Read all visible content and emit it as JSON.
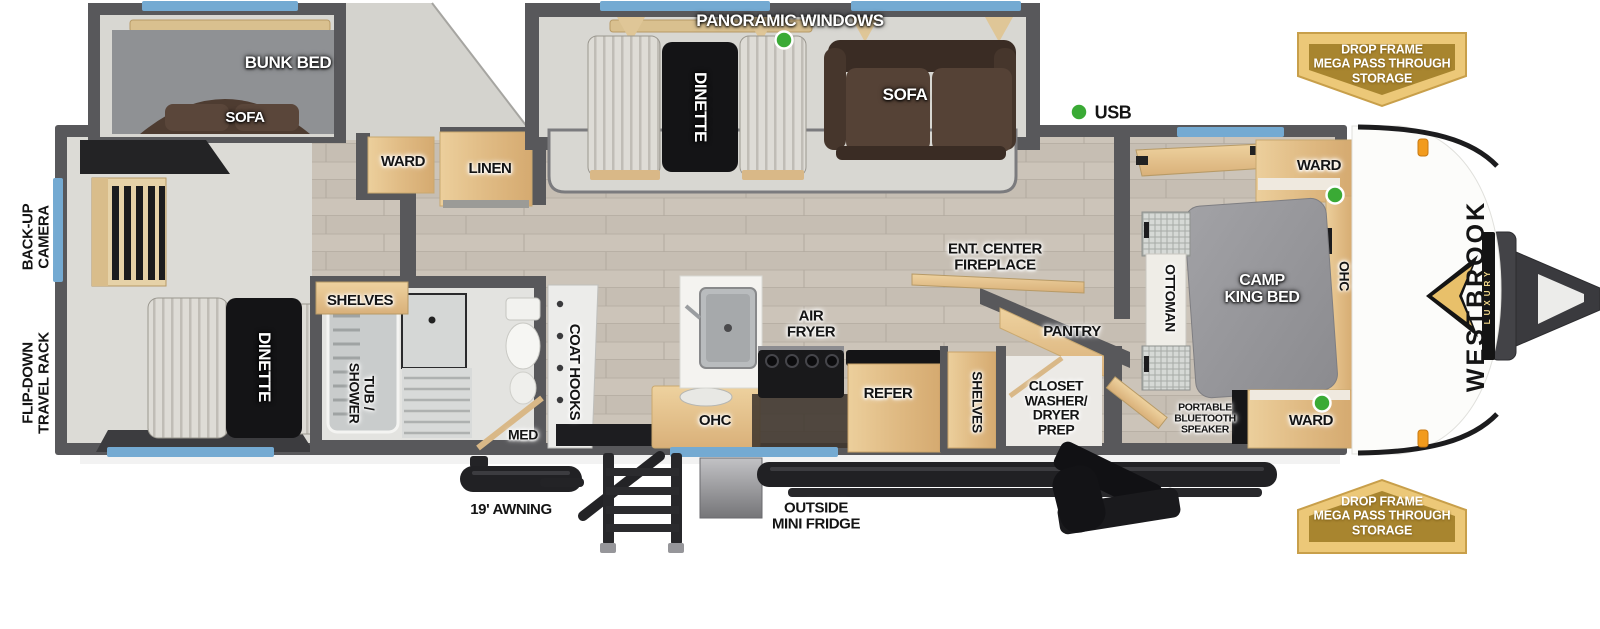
{
  "meta": {
    "type": "rv-travel-trailer-floorplan",
    "brand": "WESTBROOK",
    "brand_sub": "LUXURY"
  },
  "labels": {
    "panoramic_windows": "PANORAMIC WINDOWS",
    "bunk_bed": "BUNK BED",
    "bunk_sofa": "SOFA",
    "dinette_slide": "DINETTE",
    "sofa": "SOFA",
    "usb": "USB",
    "ward_hall": "WARD",
    "linen": "LINEN",
    "backup_camera": "BACK-UP\nCAMERA",
    "travel_rack": "FLIP-DOWN\nTRAVEL RACK",
    "dinette_front": "DINETTE",
    "shelves_bath": "SHELVES",
    "tub_shower": "TUB /\nSHOWER",
    "med": "MED",
    "coat_hooks": "COAT HOOKS",
    "ohc_kitchen": "OHC",
    "air_fryer": "AIR\nFRYER",
    "refer": "REFER",
    "shelves_closet": "SHELVES",
    "closet_wd": "CLOSET\nWASHER/\nDRYER\nPREP",
    "ent_center": "ENT. CENTER\nFIREPLACE",
    "pantry": "PANTRY",
    "ottoman": "OTTOMAN",
    "camp_king_bed": "CAMP\nKING BED",
    "ward_bed_top": "WARD",
    "ward_bed_bottom": "WARD",
    "ohc_bedroom": "OHC",
    "bt_speaker": "PORTABLE\nBLUETOOTH\nSPEAKER",
    "awning": "19' AWNING",
    "outside_fridge": "OUTSIDE\nMINI FRIDGE",
    "storage_badge": "DROP FRAME\nMEGA PASS THROUGH\nSTORAGE",
    "brand": "WESTBROOK",
    "brand_sub": "LUXURY"
  },
  "indicators": {
    "led_dot_color": "#3aaa35",
    "led_dots": [
      "panoramic-window-led",
      "usb-port-led",
      "ward-top-led",
      "ward-bottom-led"
    ]
  },
  "colors": {
    "wall": "#58585b",
    "floor_wood": "#ccc4b9",
    "slide_floor": "#d8d7d2",
    "cabinet_wood": "#e2bd85",
    "window_blue": "#74aad2",
    "badge_gold_outer": "#ecc878",
    "badge_gold_inner": "#a8852f",
    "sofa_brown": "#554236",
    "bed_gray": "#97979b",
    "accent_black": "#1c1c1e",
    "marker_orange": "#f29b1d"
  }
}
